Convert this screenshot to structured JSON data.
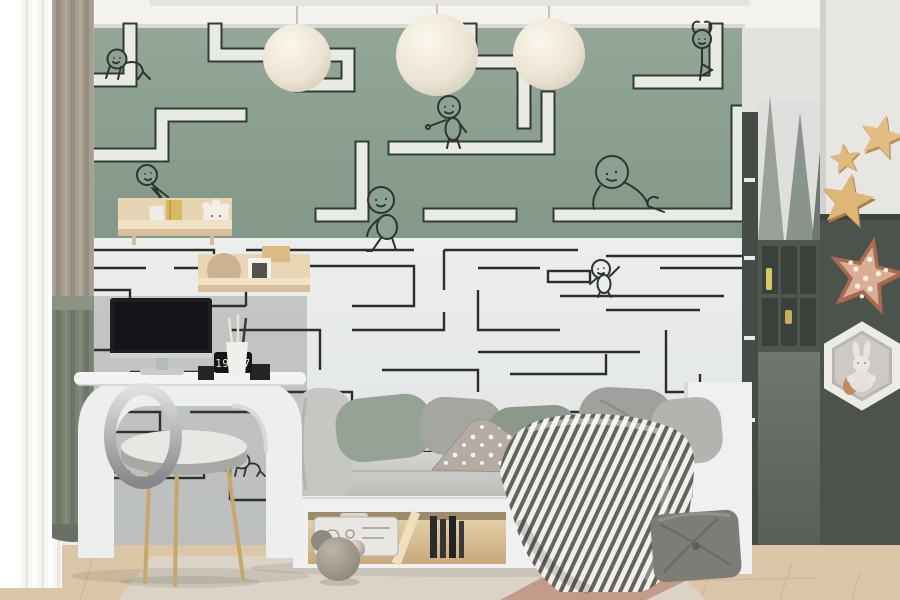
{
  "scene": {
    "description": "Children's room with maze mural wallpaper, daybed, white desk and star decor",
    "wall_mural": "maze corridors with cartoon kid figures"
  },
  "desk": {
    "clock_time": "19:07"
  },
  "counts": {
    "pendant_lamps": 3,
    "wall_stars": 3,
    "maze_figures": 8
  },
  "colors": {
    "wall_green": "#8ca094",
    "wall_white": "#e9ebec",
    "accent_dark_wall": "#4c534d",
    "maze_line": "#2b2e2b",
    "maze_path_white": "#e7eae5",
    "star_tan": "#e0b97f",
    "star_light_copper": "#aa6a52",
    "floor_wood": "#dcc6a8"
  }
}
